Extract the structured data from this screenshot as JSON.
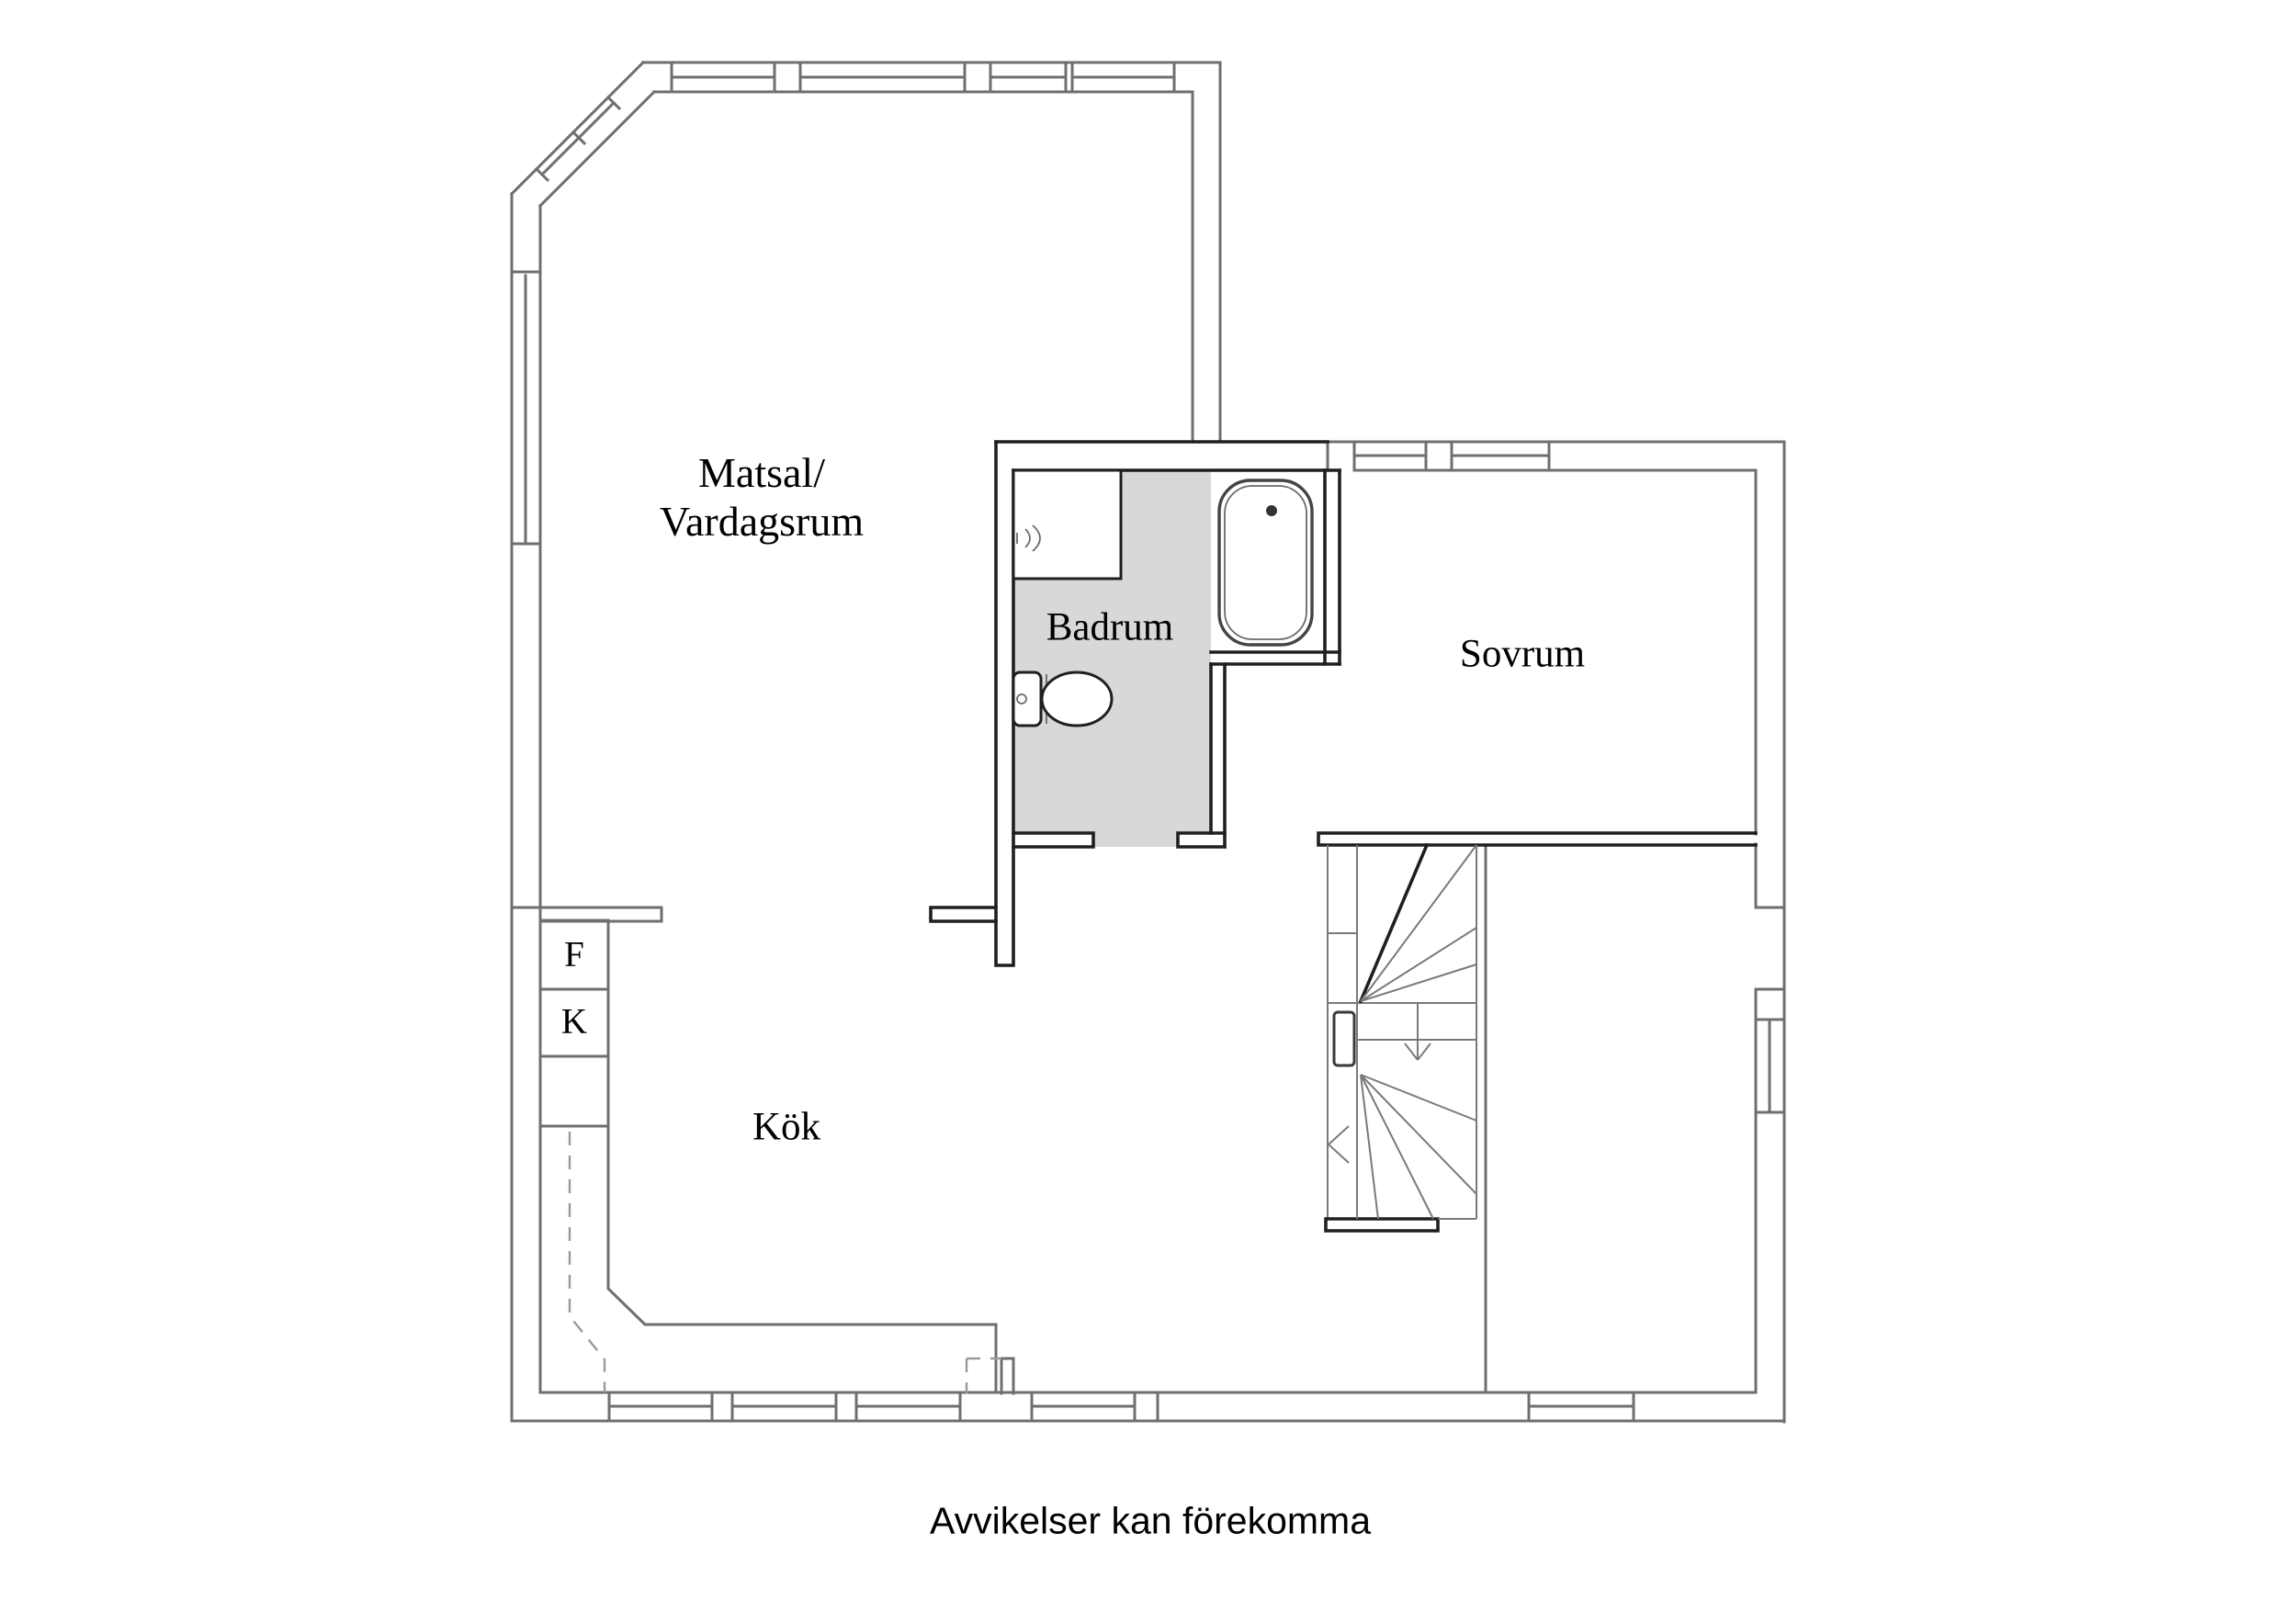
{
  "caption": "Avvikelser kan förekomma",
  "rooms": {
    "living": {
      "line1": "Matsal/",
      "line2": "Vardagsrum"
    },
    "bathroom": {
      "label": "Badrum"
    },
    "bedroom": {
      "label": "Sovrum"
    },
    "kitchen": {
      "label": "Kök"
    }
  },
  "appliances": {
    "freezer": "F",
    "fridge": "K"
  },
  "colors": {
    "wall_gray": "#6f6f6f",
    "wall_dark": "#1f1f1f",
    "bath_floor": "#d8d8d8",
    "dash_gray": "#9a9a9a",
    "text_color": "#000000",
    "bg": "#ffffff"
  }
}
